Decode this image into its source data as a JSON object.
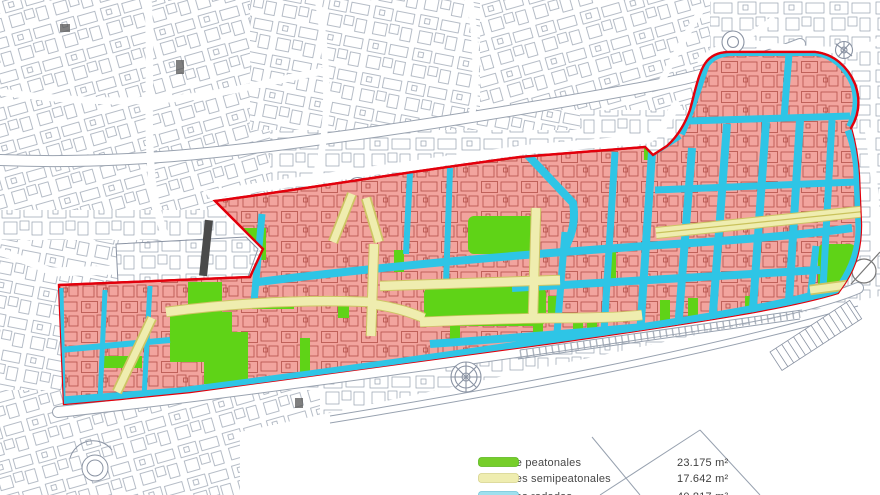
{
  "title": "Plano de peatonalización del centro urbano",
  "colors": {
    "zone_fill": "#F2A49E",
    "zone_border": "#E2000C",
    "road_street": "#2EC5E6",
    "pedestrian_street": "#5FD317",
    "semipedestrian_street": "#EFEDAF",
    "semipedestrian_edge": "#CDC564",
    "building_outline": "#A84038",
    "cadastral_line": "#97A1AF"
  },
  "legend": {
    "rows": [
      {
        "label": "Calle peatonales",
        "value": "23.175 m²",
        "swatch": "#76CE2A",
        "clipped": false
      },
      {
        "label": "Calles semipeatonales",
        "value": "17.642 m²",
        "swatch": "#EFEDB0",
        "clipped": false
      },
      {
        "label": "Calles rodadas",
        "value": "40.817 m²",
        "swatch": "#9EE0EE",
        "clipped": true
      }
    ]
  }
}
